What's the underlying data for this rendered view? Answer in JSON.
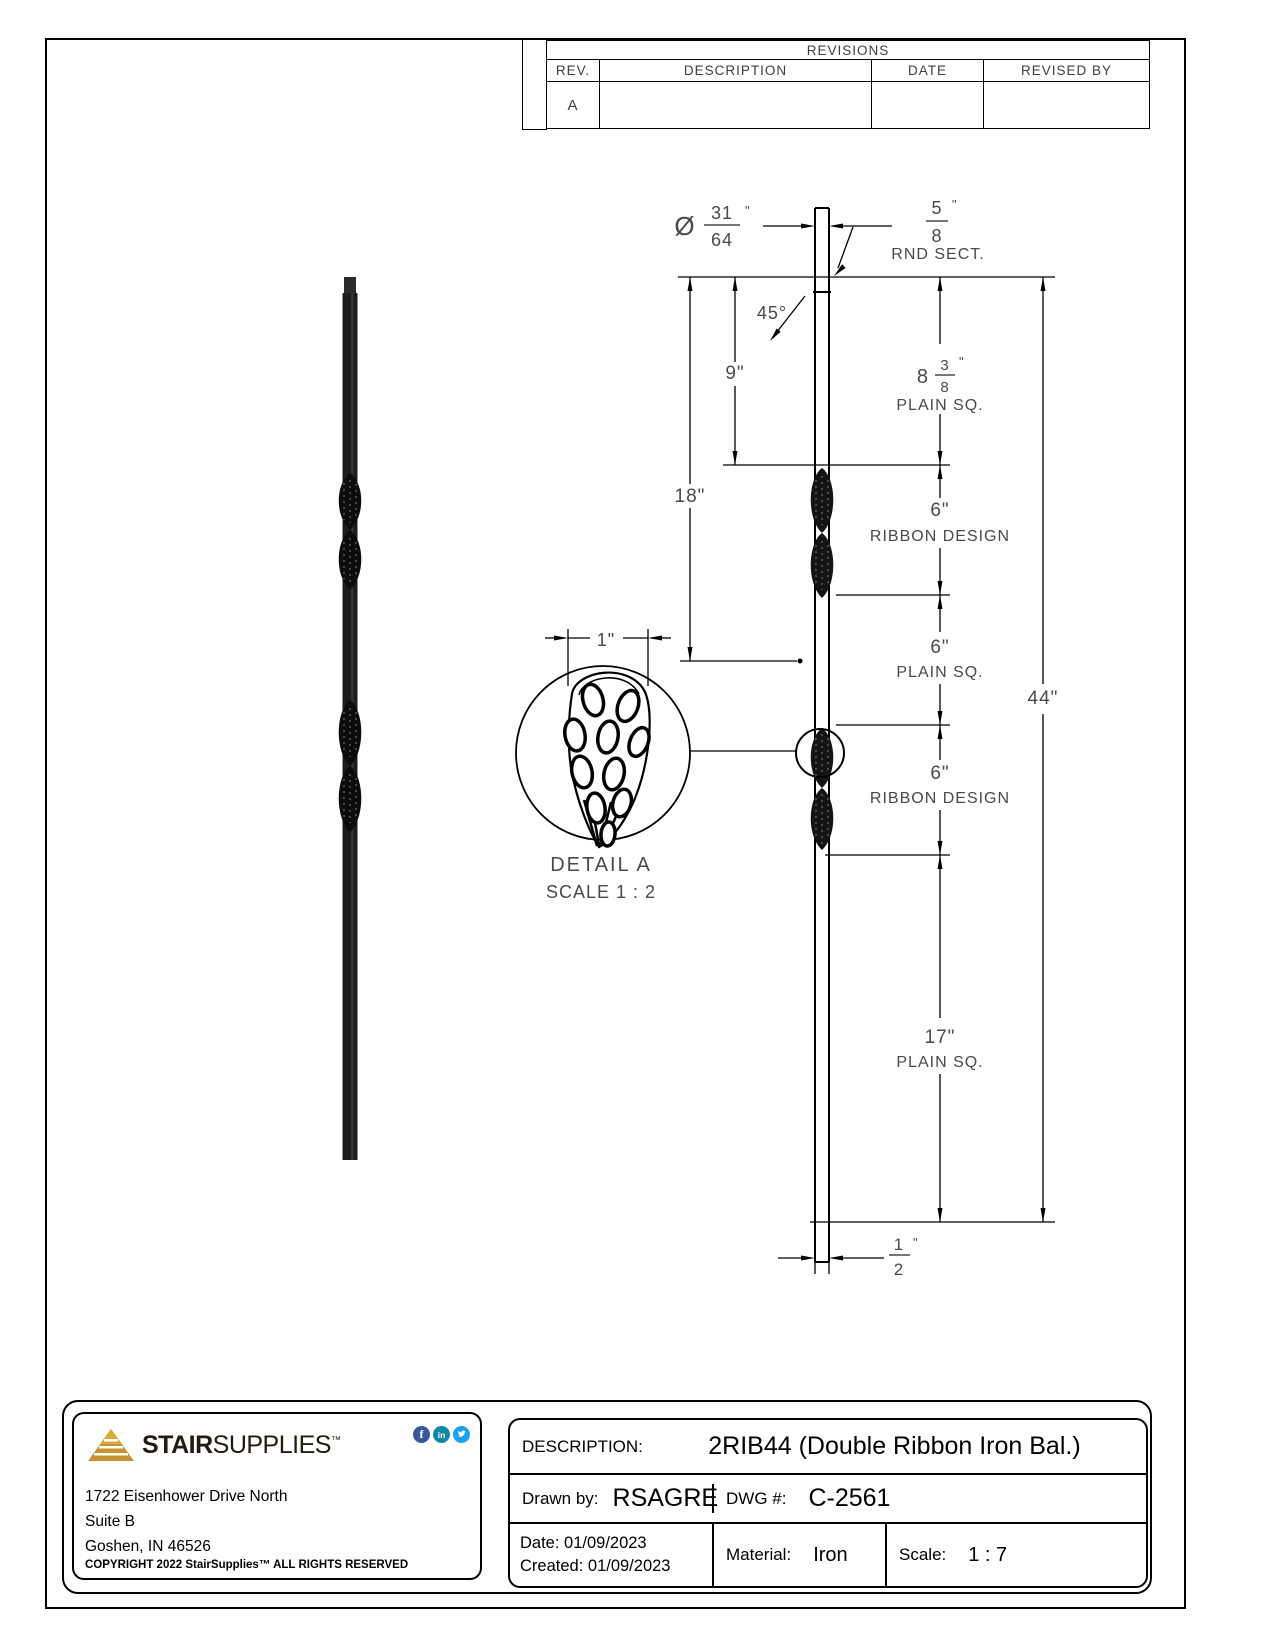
{
  "revisions": {
    "title": "REVISIONS",
    "columns": [
      "REV.",
      "DESCRIPTION",
      "DATE",
      "REVISED BY"
    ],
    "row_a": {
      "rev": "A",
      "description": "",
      "date": "",
      "revised_by": ""
    }
  },
  "dimensions": {
    "unit": "\"",
    "dia": {
      "sym": "Ø",
      "num": "31",
      "den": "64"
    },
    "rnd": {
      "num": "5",
      "den": "8",
      "label": "RND SECT."
    },
    "angle": "45°",
    "nine": "9\"",
    "eighteen": "18\"",
    "plain_top": {
      "whole": "8",
      "num": "3",
      "den": "8",
      "label": "PLAIN SQ."
    },
    "ribbon1": {
      "value": "6\"",
      "label": "RIBBON DESIGN"
    },
    "plain_mid": {
      "value": "6\"",
      "label": "PLAIN SQ."
    },
    "ribbon2": {
      "value": "6\"",
      "label": "RIBBON DESIGN"
    },
    "overall": "44\"",
    "plain_bottom": {
      "value": "17\"",
      "label": "PLAIN SQ."
    },
    "half": {
      "num": "1",
      "den": "2"
    },
    "detail_width": "1\""
  },
  "detail": {
    "title": "DETAIL A",
    "scale": "SCALE 1 : 2"
  },
  "title_block": {
    "brand": {
      "bold": "STAIR",
      "regular": "SUPPLIES",
      "tm": "™"
    },
    "address_line1": "1722 Eisenhower Drive North",
    "address_line2": "Suite B",
    "address_line3": "Goshen, IN 46526",
    "copyright": "COPYRIGHT 2022 StairSupplies™ ALL RIGHTS RESERVED",
    "description_label": "DESCRIPTION:",
    "description_value": "2RIB44 (Double Ribbon Iron Bal.)",
    "drawn_by_label": "Drawn by:",
    "drawn_by_value": "RSAGRE",
    "dwg_label": "DWG #:",
    "dwg_value": "C-2561",
    "date_label": "Date:",
    "date_value": "01/09/2023",
    "created_label": "Created:",
    "created_value": "01/09/2023",
    "material_label": "Material:",
    "material_value": "Iron",
    "scale_label": "Scale:",
    "scale_value": "1 : 7"
  },
  "icons": {
    "facebook": "f",
    "linkedin": "in"
  },
  "colors": {
    "gold": "#C79430",
    "facebook": "#39579A",
    "linkedin": "#1287A8",
    "twitter": "#1DA1F2",
    "line": "#000000",
    "dim_text": "#4A4A4A"
  }
}
